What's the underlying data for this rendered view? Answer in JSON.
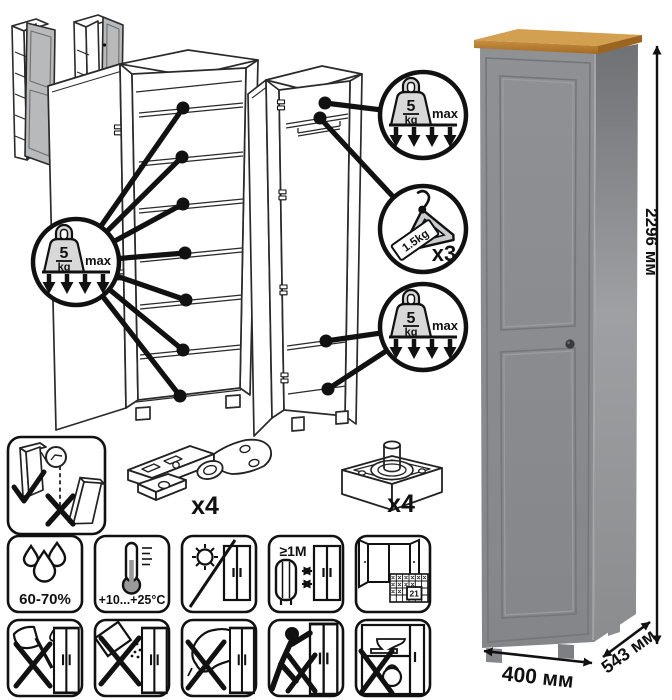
{
  "badges": {
    "shelf_load": {
      "value": "5",
      "unit": "kg",
      "qualifier": "max"
    },
    "hanger_load": {
      "tag": "1.5kg",
      "count": "x3"
    }
  },
  "hardware": {
    "hinge_qty": "x4",
    "foot_qty": "x4"
  },
  "care": {
    "humidity": "60-70%",
    "temperature": "+10...+25°C",
    "min_distance": "≥1M",
    "calendar_day": "21"
  },
  "dimensions": {
    "height": "2296 мм",
    "width": "400 мм",
    "depth": "543 мм"
  },
  "colors": {
    "ink": "#111111",
    "diagram_door_gray": "#b7b9bb",
    "weight_gray": "#d8d8d8",
    "hanger_gray": "#cbccce",
    "wood_top": "#b8802f",
    "cabinet_front": "#8a8c8f",
    "cabinet_side": "#939598",
    "knob": "#3a3a3c"
  }
}
